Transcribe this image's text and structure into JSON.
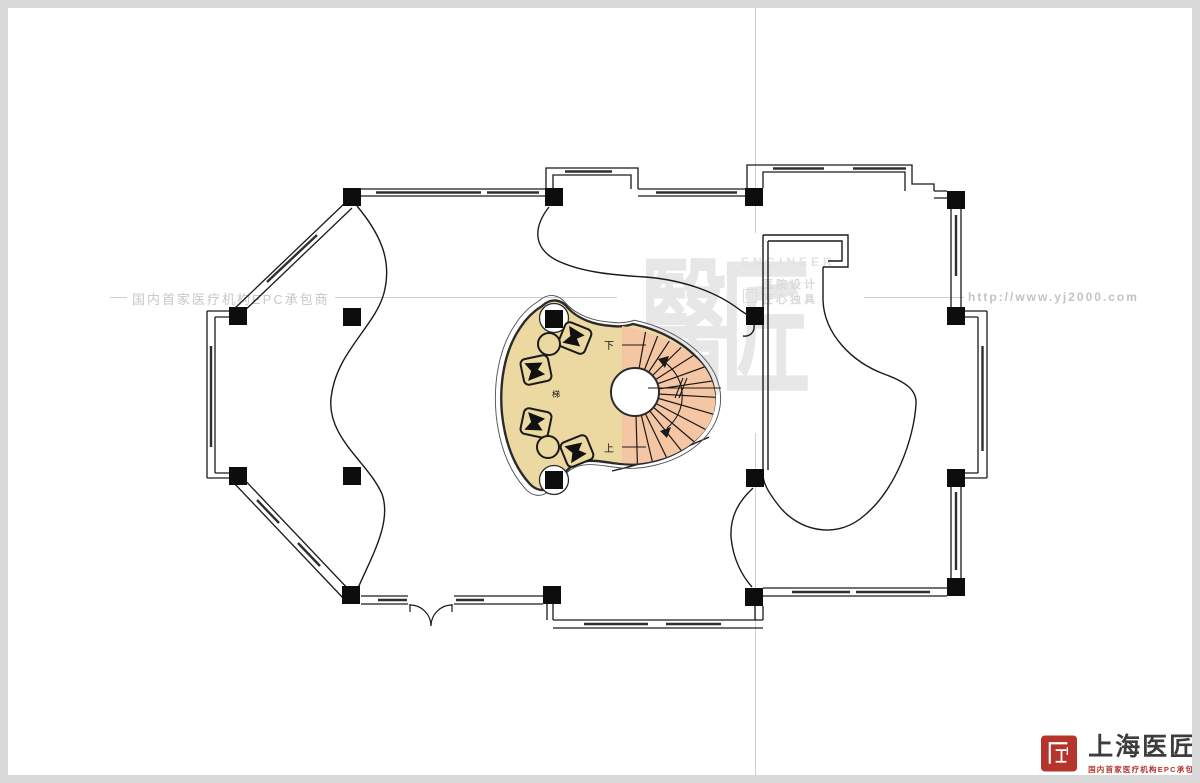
{
  "watermark": {
    "left_tagline": "国内首家医疗机构EPC承包商",
    "website": "http://www.yj2000.com",
    "brand_chars": "醫匠",
    "engineer_label": "ENGINEER",
    "design_line": "医院设计",
    "craft_line": "匠心独具"
  },
  "plan": {
    "stair_down_label": "下",
    "stair_up_label": "上",
    "stair_note": "梯",
    "colors": {
      "floor": "#ebd9a1",
      "stair": "#f5c6a4",
      "wall": "#1a1a1a",
      "furniture": "#111111"
    }
  },
  "footer_logo": {
    "company_name": "上海医匠",
    "tagline": "国内首家医疗机构EPC承包商",
    "seal_color": "#b5342c"
  }
}
